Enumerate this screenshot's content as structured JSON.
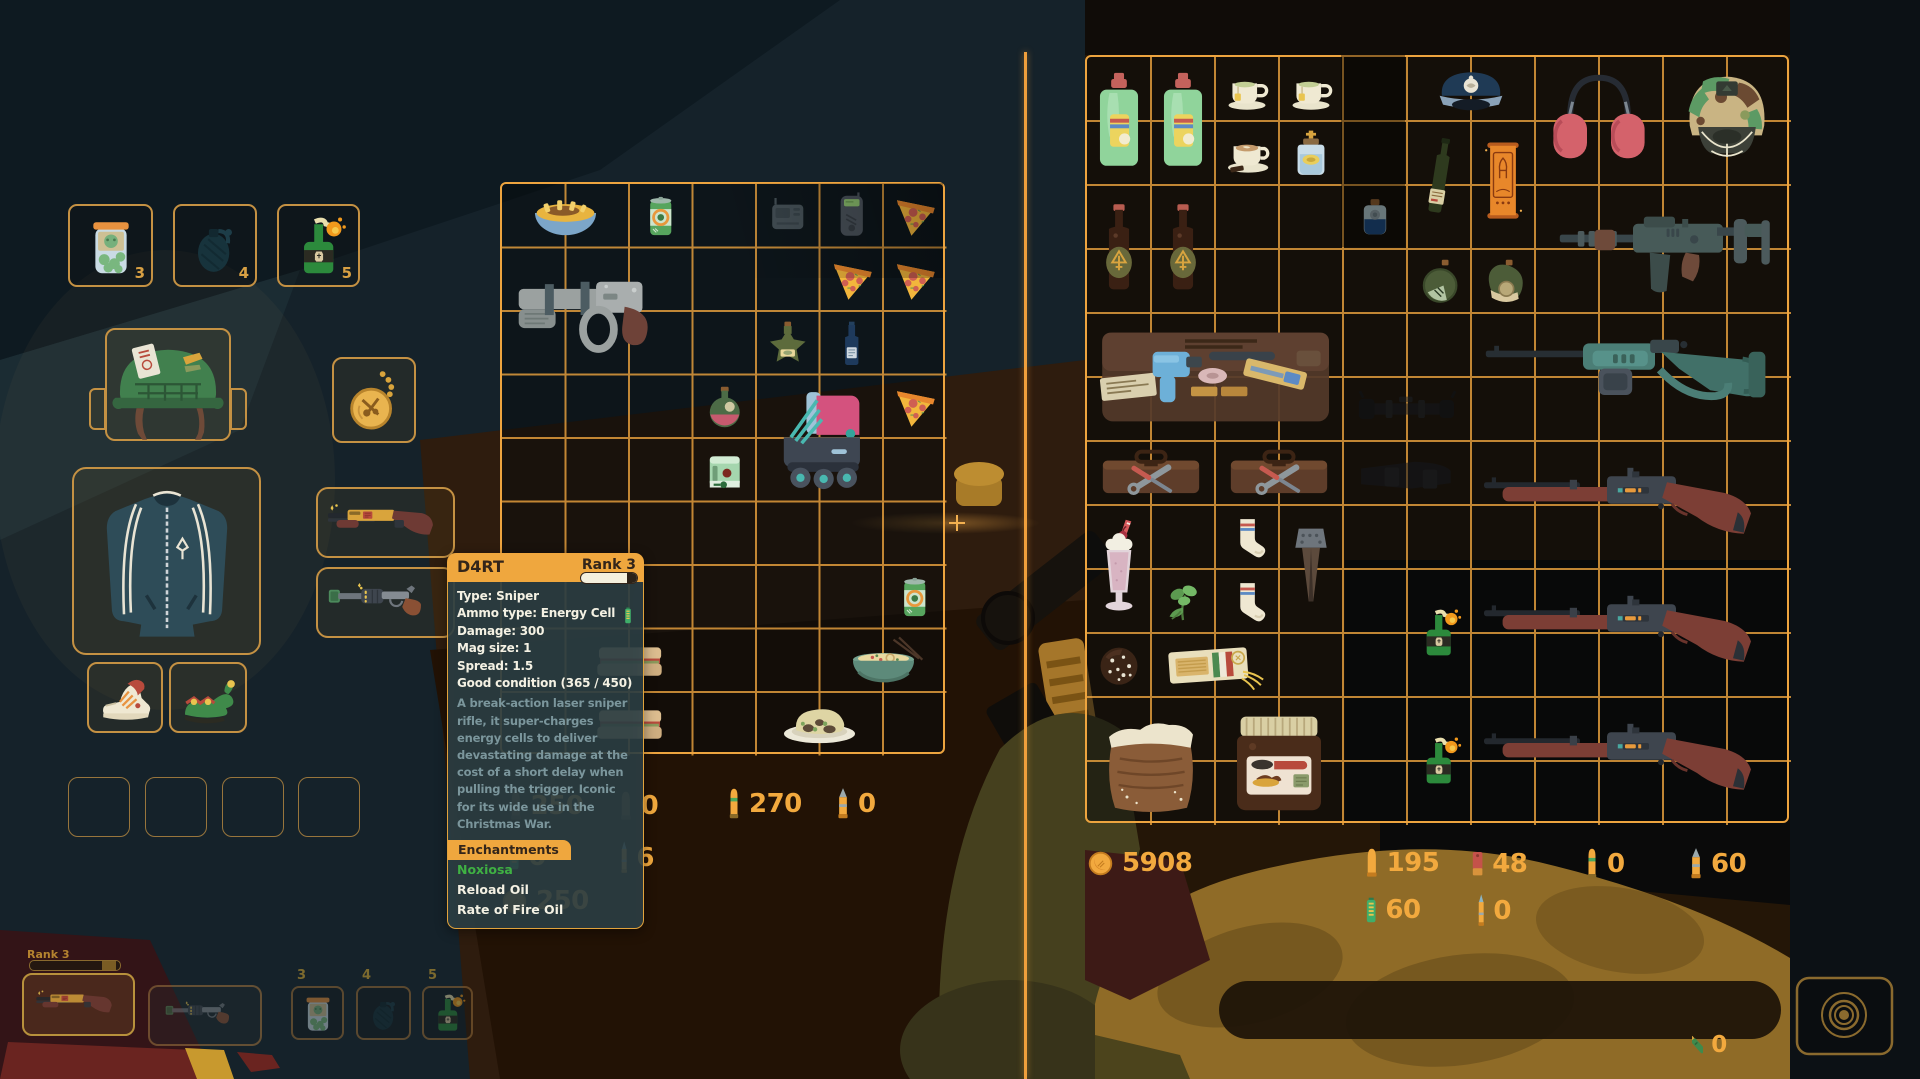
{
  "colors": {
    "accent_orange": "#f0a440",
    "grid_line": "#eda43f",
    "money_text": "#f2a93e",
    "tooltip_header": "#efa73e",
    "tooltip_body": "#2d4046",
    "enchant_positive": "#3fb143",
    "divider": "#ef9f3c"
  },
  "quickbar_top": {
    "slots": [
      {
        "hotkey": "3",
        "item": "pickle-jar",
        "icon": "pickle_jar"
      },
      {
        "hotkey": "4",
        "item": "frag-grenade",
        "icon": "grenade"
      },
      {
        "hotkey": "5",
        "item": "molotov-cocktail",
        "icon": "molotov"
      }
    ]
  },
  "equipment": {
    "head": {
      "item": "military-helmet",
      "icon": "helmet_green"
    },
    "amulet": {
      "item": "pocket-watch-amulet",
      "icon": "compass_amulet"
    },
    "body": {
      "item": "track-jacket",
      "icon": "jacket"
    },
    "weapon_primary": {
      "item": "d4rt-sniper",
      "icon": "shotgun_yellow"
    },
    "weapon_secondary": {
      "item": "revolver",
      "icon": "revolver"
    },
    "shoe_left": {
      "item": "sneaker",
      "icon": "sneaker"
    },
    "shoe_right": {
      "item": "elf-shoe",
      "icon": "elf_shoe"
    },
    "pouch_slots": 4
  },
  "player_grid": {
    "cols": 7,
    "rows": 9,
    "items": [
      {
        "name": "fries-bowl",
        "icon": "fries_bowl",
        "col": 1,
        "row": 1,
        "w": 2,
        "h": 1
      },
      {
        "name": "soda-can",
        "icon": "soda_can",
        "col": 3,
        "row": 1,
        "w": 1,
        "h": 1
      },
      {
        "name": "radio",
        "icon": "radio_grey",
        "col": 5,
        "row": 1,
        "w": 1,
        "h": 1,
        "dim": true
      },
      {
        "name": "scanner",
        "icon": "phone_device",
        "col": 6,
        "row": 1,
        "w": 1,
        "h": 1
      },
      {
        "name": "pizza-slice",
        "icon": "pizza",
        "col": 7,
        "row": 1,
        "w": 1,
        "h": 1
      },
      {
        "name": "scrap-blaster",
        "icon": "scifi_gun",
        "col": 1,
        "row": 2,
        "w": 3,
        "h": 2
      },
      {
        "name": "pizza-slice",
        "icon": "pizza",
        "col": 6,
        "row": 2,
        "w": 1,
        "h": 1
      },
      {
        "name": "pizza-slice",
        "icon": "pizza",
        "col": 7,
        "row": 2,
        "w": 1,
        "h": 1
      },
      {
        "name": "star-bottle",
        "icon": "star_bottle",
        "col": 5,
        "row": 3,
        "w": 1,
        "h": 1
      },
      {
        "name": "wine-bottle",
        "icon": "wine_bottle",
        "col": 6,
        "row": 3,
        "w": 1,
        "h": 1
      },
      {
        "name": "oil-flask",
        "icon": "oil_flask",
        "col": 4,
        "row": 4,
        "w": 1,
        "h": 1
      },
      {
        "name": "roller-skate",
        "icon": "skate",
        "col": 5,
        "row": 4,
        "w": 2,
        "h": 2
      },
      {
        "name": "pizza-slice",
        "icon": "pizza",
        "col": 7,
        "row": 4,
        "w": 1,
        "h": 1
      },
      {
        "name": "ammo-box",
        "icon": "green_box",
        "col": 4,
        "row": 5,
        "w": 1,
        "h": 1
      },
      {
        "name": "soda-can",
        "icon": "soda_can",
        "col": 7,
        "row": 7,
        "w": 1,
        "h": 1
      },
      {
        "name": "sandwich",
        "icon": "sandwich",
        "col": 2,
        "row": 8,
        "w": 2,
        "h": 1
      },
      {
        "name": "ramen-bowl",
        "icon": "ramen_bowl",
        "col": 6,
        "row": 8,
        "w": 2,
        "h": 1
      },
      {
        "name": "sandwich",
        "icon": "sandwich",
        "col": 2,
        "row": 9,
        "w": 2,
        "h": 1
      },
      {
        "name": "food-plate",
        "icon": "food_plate",
        "col": 5,
        "row": 9,
        "w": 2,
        "h": 1
      }
    ]
  },
  "stash_grid": {
    "cols": 11,
    "rows": 12,
    "items": [
      {
        "name": "detergent-bottle",
        "icon": "detergent",
        "col": 1,
        "row": 1,
        "w": 1,
        "h": 2
      },
      {
        "name": "detergent-bottle",
        "icon": "detergent",
        "col": 2,
        "row": 1,
        "w": 1,
        "h": 2
      },
      {
        "name": "teacup",
        "icon": "teacup",
        "col": 3,
        "row": 1,
        "w": 1,
        "h": 1
      },
      {
        "name": "teacup",
        "icon": "teacup",
        "col": 4,
        "row": 1,
        "w": 1,
        "h": 1
      },
      {
        "name": "coffee-cup",
        "icon": "coffee_cup",
        "col": 3,
        "row": 2,
        "w": 1,
        "h": 1
      },
      {
        "name": "holy-water",
        "icon": "holy_water",
        "col": 4,
        "row": 2,
        "w": 1,
        "h": 1
      },
      {
        "name": "captain-hat",
        "icon": "captain_hat",
        "col": 6,
        "row": 1,
        "w": 2,
        "h": 1
      },
      {
        "name": "dark-wine-bottle",
        "icon": "dark_bottle",
        "col": 6,
        "row": 2,
        "w": 1,
        "h": 2
      },
      {
        "name": "rocket-scroll",
        "icon": "scroll",
        "col": 7,
        "row": 2,
        "w": 1,
        "h": 2
      },
      {
        "name": "blue-potion",
        "icon": "blue_potion",
        "col": 5,
        "row": 3,
        "w": 1,
        "h": 1
      },
      {
        "name": "beer-bottle",
        "icon": "beer",
        "col": 1,
        "row": 3,
        "w": 1,
        "h": 2
      },
      {
        "name": "beer-bottle",
        "icon": "beer",
        "col": 2,
        "row": 3,
        "w": 1,
        "h": 2
      },
      {
        "name": "herb-flask",
        "icon": "flask_herb",
        "col": 6,
        "row": 4,
        "w": 1,
        "h": 1
      },
      {
        "name": "coin-flask",
        "icon": "flask_coin",
        "col": 7,
        "row": 4,
        "w": 1,
        "h": 1
      },
      {
        "name": "ear-defenders",
        "icon": "headphones",
        "col": 8,
        "row": 1,
        "w": 2,
        "h": 2
      },
      {
        "name": "combat-helmet",
        "icon": "camo_helmet",
        "col": 10,
        "row": 1,
        "w": 2,
        "h": 2
      },
      {
        "name": "assault-rifle",
        "icon": "assault_rifle",
        "col": 8,
        "row": 3,
        "w": 4,
        "h": 2
      },
      {
        "name": "tool-case",
        "icon": "tool_case",
        "col": 1,
        "row": 5,
        "w": 4,
        "h": 2
      },
      {
        "name": "toolbox",
        "icon": "toolbox",
        "col": 1,
        "row": 7,
        "w": 2,
        "h": 1
      },
      {
        "name": "toolbox",
        "icon": "toolbox",
        "col": 3,
        "row": 7,
        "w": 2,
        "h": 1
      },
      {
        "name": "rifle-scope",
        "icon": "scope_dark",
        "col": 5,
        "row": 6,
        "w": 2,
        "h": 1,
        "dim": true
      },
      {
        "name": "gun-stock",
        "icon": "stock_dark",
        "col": 5,
        "row": 7,
        "w": 2,
        "h": 1,
        "dim": true
      },
      {
        "name": "lever-sniper",
        "icon": "teal_rifle",
        "col": 7,
        "row": 5,
        "w": 5,
        "h": 2
      },
      {
        "name": "hunting-rifle",
        "icon": "red_rifle",
        "col": 7,
        "row": 7,
        "w": 5,
        "h": 2
      },
      {
        "name": "milkshake",
        "icon": "milkshake",
        "col": 1,
        "row": 8,
        "w": 1,
        "h": 2
      },
      {
        "name": "sock",
        "icon": "sock",
        "col": 3,
        "row": 8,
        "w": 1,
        "h": 1
      },
      {
        "name": "rail-spike",
        "icon": "spike",
        "col": 4,
        "row": 8,
        "w": 1,
        "h": 2
      },
      {
        "name": "herb-sprig",
        "icon": "herb",
        "col": 2,
        "row": 9,
        "w": 1,
        "h": 1
      },
      {
        "name": "sock",
        "icon": "sock",
        "col": 3,
        "row": 9,
        "w": 1,
        "h": 1
      },
      {
        "name": "molotov-cocktail",
        "icon": "molotov",
        "col": 6,
        "row": 9,
        "w": 1,
        "h": 2
      },
      {
        "name": "hunting-rifle",
        "icon": "red_rifle",
        "col": 7,
        "row": 9,
        "w": 5,
        "h": 2
      },
      {
        "name": "chocolate-cookie",
        "icon": "cookie",
        "col": 1,
        "row": 10,
        "w": 1,
        "h": 1
      },
      {
        "name": "spaghetti-pack",
        "icon": "spaghetti",
        "col": 2,
        "row": 10,
        "w": 2,
        "h": 1
      },
      {
        "name": "flour-sack",
        "icon": "flour_sack",
        "col": 1,
        "row": 11,
        "w": 2,
        "h": 2
      },
      {
        "name": "chocolate-spread-jar",
        "icon": "nutella",
        "col": 3,
        "row": 11,
        "w": 2,
        "h": 2
      },
      {
        "name": "molotov-cocktail",
        "icon": "molotov",
        "col": 6,
        "row": 11,
        "w": 1,
        "h": 2
      },
      {
        "name": "hunting-rifle",
        "icon": "red_rifle",
        "col": 7,
        "row": 11,
        "w": 5,
        "h": 2
      }
    ]
  },
  "player_money": "250",
  "player_ammo": [
    {
      "icon": "shell_dim",
      "value": "250"
    },
    {
      "icon": "shell_dim",
      "value": "0"
    },
    {
      "icon": "rifle_bullet",
      "value": "270"
    },
    {
      "icon": "ap_bullet",
      "value": "0"
    },
    {
      "icon": "battery",
      "value": "0"
    },
    {
      "icon": "thin_bullet",
      "value": "6"
    }
  ],
  "stash_money": "5908",
  "stash_ammo": [
    {
      "icon": "pistol_bullet",
      "value": "195"
    },
    {
      "icon": "shotshell",
      "value": "48"
    },
    {
      "icon": "rifle_bullet",
      "value": "0"
    },
    {
      "icon": "ap_bullet",
      "value": "60"
    },
    {
      "icon": "battery",
      "value": "60"
    },
    {
      "icon": "thin_bullet",
      "value": "0"
    }
  ],
  "special_counter": {
    "icon": "green_cart",
    "value": "0"
  },
  "tooltip": {
    "title": "D4RT",
    "rank": "Rank 3",
    "stats": [
      "Type: Sniper",
      "Ammo type: Energy Cell",
      "Damage: 300",
      "Mag size: 1",
      "Spread: 1.5",
      "Good condition (365 / 450)"
    ],
    "ammo_icon": "energy-cell",
    "description": "A break-action laser sniper rifle, it super-charges energy cells to deliver devastating damage at the cost of a short delay when pulling the trigger. Iconic for its wide use in the Christmas War.",
    "enchantments_label": "Enchantments",
    "enchantments": [
      {
        "name": "Noxiosa",
        "quality": "positive"
      },
      {
        "name": "Reload Oil",
        "quality": "normal"
      },
      {
        "name": "Rate of Fire Oil",
        "quality": "normal"
      }
    ]
  },
  "hud": {
    "rank_label": "Rank 3",
    "xp_progress": 0.8,
    "weapon_primary_icon": "shotgun_yellow",
    "weapon_secondary_icon": "revolver",
    "quickslots": [
      {
        "hotkey": "3",
        "icon": "pickle_jar"
      },
      {
        "hotkey": "4",
        "icon": "grenade"
      },
      {
        "hotkey": "5",
        "icon": "molotov"
      }
    ]
  }
}
